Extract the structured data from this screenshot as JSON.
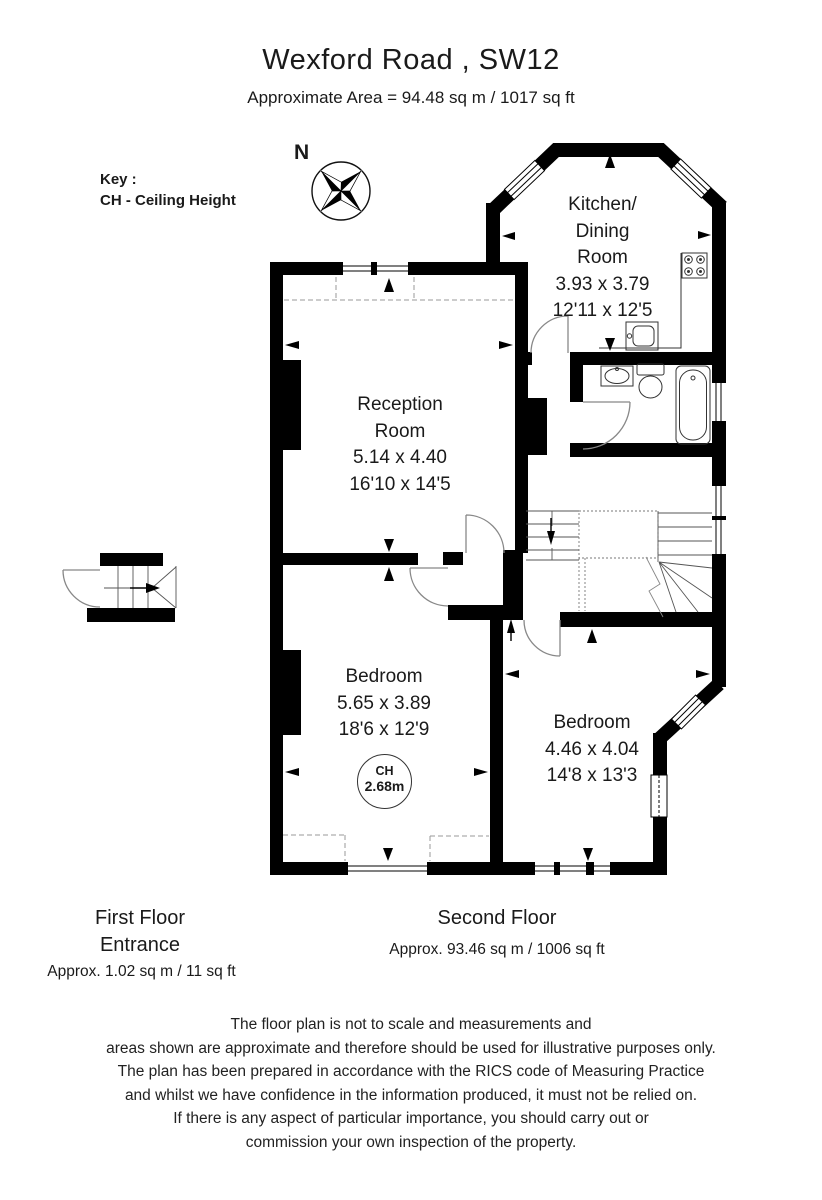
{
  "header": {
    "title": "Wexford Road , SW12",
    "area_line": "Approximate Area =  94.48 sq m / 1017 sq ft"
  },
  "key": {
    "title": "Key :",
    "entry": "CH - Ceiling Height"
  },
  "compass": {
    "north_label": "N"
  },
  "rooms": {
    "kitchen": {
      "name": "Kitchen/\nDining\nRoom",
      "dims_m": "3.93 x 3.79",
      "dims_ft": "12'11 x 12'5"
    },
    "reception": {
      "name": "Reception\nRoom",
      "dims_m": "5.14 x 4.40",
      "dims_ft": "16'10 x 14'5"
    },
    "bedroom1": {
      "name": "Bedroom",
      "dims_m": "5.65 x 3.89",
      "dims_ft": "18'6 x 12'9"
    },
    "bedroom2": {
      "name": "Bedroom",
      "dims_m": "4.46 x 4.04",
      "dims_ft": "14'8 x 13'3"
    }
  },
  "ceiling_height": {
    "label": "CH",
    "value": "2.68m"
  },
  "floors": {
    "first": {
      "title": "First Floor\nEntrance",
      "area": "Approx. 1.02 sq m / 11 sq ft"
    },
    "second": {
      "title": "Second Floor",
      "area": "Approx. 93.46 sq m / 1006 sq ft"
    }
  },
  "disclaimer": "The floor plan is not to scale and measurements and\nareas shown are approximate and therefore should be used for illustrative purposes only.\nThe plan has been prepared in accordance with the RICS code of Measuring Practice\nand whilst we have confidence in the information produced, it must not be relied on.\nIf there is any aspect of particular importance, you should carry out or\ncommission your own inspection of the property.",
  "colors": {
    "wall": "#000000",
    "text": "#1a1a1a",
    "thin_line": "#555555"
  }
}
